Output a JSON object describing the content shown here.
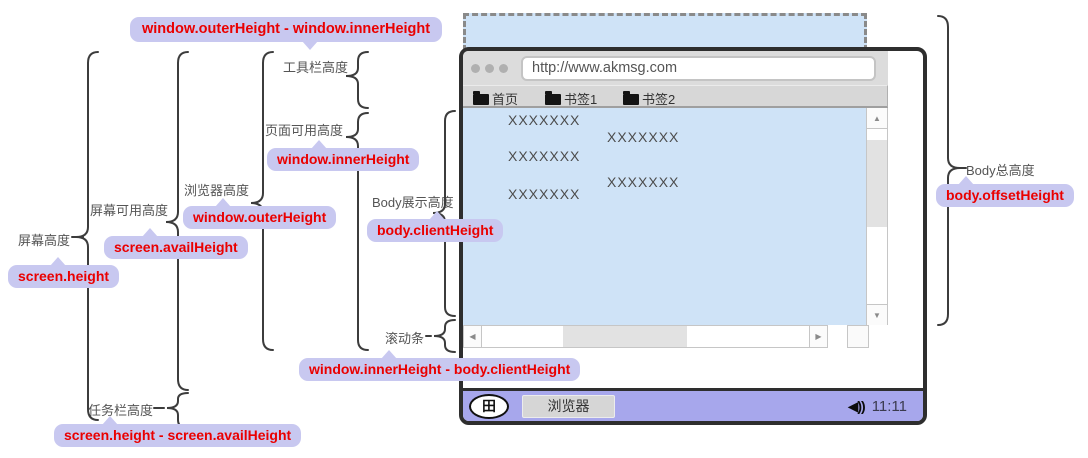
{
  "annotations": {
    "toolbar_diff_code": "window.outerHeight - window.innerHeight",
    "screen_height_label": "屏幕高度",
    "screen_height_code": "screen.height",
    "screen_avail_label": "屏幕可用高度",
    "screen_avail_code": "screen.availHeight",
    "browser_height_label": "浏览器高度",
    "browser_height_code": "window.outerHeight",
    "toolbar_height_label": "工具栏高度",
    "page_avail_label": "页面可用高度",
    "page_avail_code": "window.innerHeight",
    "body_display_label": "Body展示高度",
    "body_display_code": "body.clientHeight",
    "scrollbar_label": "滚动条",
    "scrollbar_diff_code": "window.innerHeight - body.clientHeight",
    "taskbar_height_label": "任务栏高度",
    "taskbar_diff_code": "screen.height - screen.availHeight",
    "body_total_label": "Body总高度",
    "body_total_code": "body.offsetHeight"
  },
  "browser": {
    "url": "http://www.akmsg.com",
    "bookmarks": [
      {
        "label": "首页"
      },
      {
        "label": "书签1"
      },
      {
        "label": "书签2"
      }
    ],
    "content_items": [
      "XXXXXXX",
      "XXXXXXX",
      "XXXXXXX",
      "XXXXXXX",
      "XXXXXXX"
    ],
    "scrollbar": {
      "up_arrow": "▲",
      "down_arrow": "▼",
      "left_arrow": "◀",
      "right_arrow": "▶"
    },
    "taskbar": {
      "start_glyph": "田",
      "app_button": "浏览器",
      "speaker_glyph": "◀))",
      "time": "11:11"
    }
  },
  "colors": {
    "bubble_bg": "#c8c8f0",
    "code_red": "#ea0000",
    "content_blue": "#cfe3f7",
    "taskbar_purple": "#a7a7ec",
    "window_border": "#2e2e2e",
    "brace": "#3c3c3c",
    "label_gray": "#555555"
  }
}
